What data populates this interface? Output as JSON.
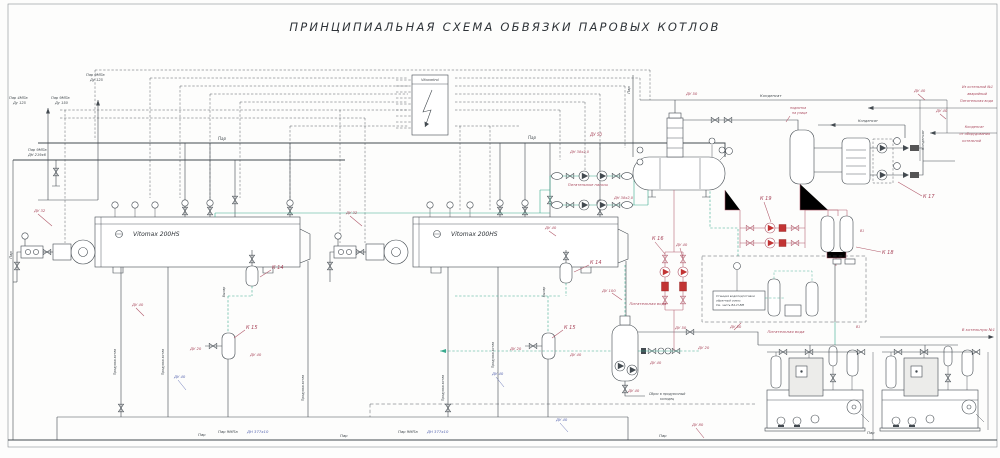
{
  "title": "ПРИНЦИПИАЛЬНАЯ СХЕМА ОБВЯЗКИ ПАРОВЫХ КОТЛОВ",
  "colors": {
    "ink": "#3f464b",
    "red": "#a8455a",
    "teal": "#3aaa8e",
    "blue": "#5463ae",
    "dark": "#2e3338"
  },
  "equipment": {
    "boiler1": "Vitomax 200HS",
    "boiler2": "Vitomax 200HS",
    "panel": "Vitocontrol"
  },
  "labels": [
    {
      "t": "Пар 9МПа",
      "x": 86,
      "y": 76,
      "s": 3.6
    },
    {
      "t": "Ду 125",
      "x": 90,
      "y": 81,
      "s": 3.6
    },
    {
      "t": "Пар 4МПа",
      "x": 9,
      "y": 99,
      "s": 3.6
    },
    {
      "t": "Ду 125",
      "x": 13,
      "y": 104,
      "s": 3.6
    },
    {
      "t": "Пар 9МПа",
      "x": 51,
      "y": 99,
      "s": 3.6
    },
    {
      "t": "Ду 150",
      "x": 55,
      "y": 104,
      "s": 3.6
    },
    {
      "t": "Пар 9МПа",
      "x": 28,
      "y": 151,
      "s": 3.6
    },
    {
      "t": "ДН 219х6",
      "x": 28,
      "y": 156,
      "s": 3.6
    },
    {
      "t": "Пар",
      "x": 218,
      "y": 140,
      "s": 4
    },
    {
      "t": "Пар",
      "x": 528,
      "y": 139,
      "s": 4
    },
    {
      "t": "ДУ 50",
      "x": 590,
      "y": 136,
      "c": "red",
      "s": 4
    },
    {
      "t": "ДН 38х2,0",
      "x": 570,
      "y": 153,
      "c": "red",
      "s": 3.6
    },
    {
      "t": "ДН 38х2,0",
      "x": 614,
      "y": 199,
      "c": "red",
      "s": 3.6
    },
    {
      "t": "Питательные насосы",
      "x": 588,
      "y": 186,
      "c": "red",
      "s": 3.6,
      "a": "middle"
    },
    {
      "t": "К 14",
      "x": 272,
      "y": 269,
      "c": "red",
      "s": 5
    },
    {
      "t": "К 14",
      "x": 590,
      "y": 264,
      "c": "red",
      "s": 5
    },
    {
      "t": "К 15",
      "x": 246,
      "y": 329,
      "c": "red",
      "s": 5
    },
    {
      "t": "К 15",
      "x": 564,
      "y": 329,
      "c": "red",
      "s": 5
    },
    {
      "t": "К 16",
      "x": 652,
      "y": 240,
      "c": "red",
      "s": 5
    },
    {
      "t": "ДУ 40",
      "x": 676,
      "y": 246,
      "c": "red",
      "s": 3.8
    },
    {
      "t": "К 19",
      "x": 760,
      "y": 200,
      "c": "red",
      "s": 5
    },
    {
      "t": "К 17",
      "x": 923,
      "y": 198,
      "c": "red",
      "s": 5
    },
    {
      "t": "К 18",
      "x": 882,
      "y": 254,
      "c": "red",
      "s": 5
    },
    {
      "t": "В1",
      "x": 860,
      "y": 232,
      "c": "red",
      "s": 3.2
    },
    {
      "t": "В1",
      "x": 856,
      "y": 328,
      "c": "red",
      "s": 3.2
    },
    {
      "t": "ДУ 50",
      "x": 686,
      "y": 95,
      "c": "red",
      "s": 3.8
    },
    {
      "t": "Конденсат",
      "x": 760,
      "y": 97,
      "s": 3.8
    },
    {
      "t": "Конденсат",
      "x": 858,
      "y": 122,
      "s": 3.5
    },
    {
      "t": "Конденсат",
      "x": 924,
      "y": 140,
      "s": 3.5,
      "r": -90,
      "a": "middle"
    },
    {
      "t": "подпитка",
      "x": 790,
      "y": 109,
      "c": "red",
      "s": 3.2
    },
    {
      "t": "на улице",
      "x": 792,
      "y": 114,
      "c": "red",
      "s": 3.2
    },
    {
      "t": "ДУ 40",
      "x": 914,
      "y": 92,
      "c": "red",
      "s": 3.8
    },
    {
      "t": "Из котельной №1",
      "x": 993,
      "y": 88,
      "c": "red",
      "s": 3.4,
      "a": "end"
    },
    {
      "t": "аварийный",
      "x": 987,
      "y": 95,
      "c": "red",
      "s": 3.4,
      "a": "end"
    },
    {
      "t": "Питательная вода",
      "x": 993,
      "y": 102,
      "c": "red",
      "s": 3.4,
      "a": "end"
    },
    {
      "t": "ДУ 40",
      "x": 936,
      "y": 112,
      "c": "red",
      "s": 3.8
    },
    {
      "t": "Конденсат",
      "x": 984,
      "y": 128,
      "c": "red",
      "s": 3.4,
      "a": "end"
    },
    {
      "t": "от оборудования",
      "x": 990,
      "y": 135,
      "c": "red",
      "s": 3.4,
      "a": "end"
    },
    {
      "t": "котельной",
      "x": 981,
      "y": 142,
      "c": "red",
      "s": 3.4,
      "a": "end"
    },
    {
      "t": "Станция водоподготовки",
      "x": 716,
      "y": 297,
      "s": 2.9
    },
    {
      "t": "обратный осмос",
      "x": 716,
      "y": 301.5,
      "s": 2.9
    },
    {
      "t": "См. часть ВА-П-ВМ",
      "x": 716,
      "y": 306,
      "s": 2.9
    },
    {
      "t": "ДУ 50",
      "x": 730,
      "y": 328,
      "c": "red",
      "s": 3.8
    },
    {
      "t": "Питательная вода",
      "x": 786,
      "y": 333,
      "c": "red",
      "s": 3.8,
      "a": "middle"
    },
    {
      "t": "ДУ 100",
      "x": 602,
      "y": 292,
      "c": "red",
      "s": 3.8
    },
    {
      "t": "Питательная вода",
      "x": 648,
      "y": 305,
      "c": "red",
      "s": 3.8,
      "a": "middle"
    },
    {
      "t": "ДУ 50",
      "x": 675,
      "y": 329,
      "c": "red",
      "s": 3.8
    },
    {
      "t": "ДУ 20",
      "x": 698,
      "y": 349,
      "c": "red",
      "s": 3.8
    },
    {
      "t": "ДУ 40",
      "x": 650,
      "y": 364,
      "c": "red",
      "s": 3.8
    },
    {
      "t": "ДУ 40",
      "x": 628,
      "y": 392,
      "c": "red",
      "s": 3.8
    },
    {
      "t": "Сброс в продувочный",
      "x": 649,
      "y": 395,
      "s": 3.2
    },
    {
      "t": "колодец",
      "x": 660,
      "y": 400,
      "s": 3.2
    },
    {
      "t": "В котельную №1",
      "x": 995,
      "y": 331,
      "c": "red",
      "s": 3.8,
      "a": "end"
    },
    {
      "t": "Пар",
      "x": 198,
      "y": 436,
      "s": 3.8
    },
    {
      "t": "Пар 9МПа",
      "x": 218,
      "y": 433,
      "s": 3.8
    },
    {
      "t": "ДН 377х10",
      "x": 247,
      "y": 433,
      "c": "blue",
      "s": 3.8
    },
    {
      "t": "Пар",
      "x": 340,
      "y": 437,
      "s": 3.8
    },
    {
      "t": "Пар 9МПа",
      "x": 398,
      "y": 433,
      "s": 3.8
    },
    {
      "t": "ДН 377х10",
      "x": 427,
      "y": 433,
      "c": "blue",
      "s": 3.8
    },
    {
      "t": "Пар",
      "x": 659,
      "y": 437,
      "s": 3.8
    },
    {
      "t": "ДУ 80",
      "x": 692,
      "y": 426,
      "c": "red",
      "s": 3.8
    },
    {
      "t": "Пар",
      "x": 867,
      "y": 434,
      "s": 3.8
    },
    {
      "t": "Продувка котла",
      "x": 116,
      "y": 362,
      "s": 3.1,
      "r": -90,
      "a": "middle"
    },
    {
      "t": "Продувка котла",
      "x": 164,
      "y": 362,
      "s": 3.1,
      "r": -90,
      "a": "middle"
    },
    {
      "t": "Продувка котла",
      "x": 304,
      "y": 388,
      "s": 3.1,
      "r": -90,
      "a": "middle"
    },
    {
      "t": "Продувка котла",
      "x": 444,
      "y": 388,
      "s": 3.1,
      "r": -90,
      "a": "middle"
    },
    {
      "t": "Продувка котла",
      "x": 494,
      "y": 355,
      "s": 3.1,
      "r": -90,
      "a": "middle"
    },
    {
      "t": "Выпар",
      "x": 225,
      "y": 292,
      "s": 3.1,
      "r": -90,
      "a": "middle"
    },
    {
      "t": "Выпар",
      "x": 545,
      "y": 292,
      "s": 3.1,
      "r": -90,
      "a": "middle"
    },
    {
      "t": "ДУ 40",
      "x": 132,
      "y": 306,
      "c": "red",
      "s": 3.8
    },
    {
      "t": "ДУ 40",
      "x": 174,
      "y": 378,
      "c": "blue",
      "s": 3.8
    },
    {
      "t": "ДУ 40",
      "x": 492,
      "y": 375,
      "c": "blue",
      "s": 3.8
    },
    {
      "t": "ДУ 40",
      "x": 556,
      "y": 421,
      "c": "blue",
      "s": 3.8
    },
    {
      "t": "ДУ 32",
      "x": 34,
      "y": 212,
      "c": "red",
      "s": 3.8
    },
    {
      "t": "ДУ 32",
      "x": 346,
      "y": 214,
      "c": "red",
      "s": 3.8
    },
    {
      "t": "ДУ 20",
      "x": 190,
      "y": 350,
      "c": "red",
      "s": 3.8
    },
    {
      "t": "ДУ 40",
      "x": 250,
      "y": 356,
      "c": "red",
      "s": 3.8
    },
    {
      "t": "ДУ 20",
      "x": 510,
      "y": 350,
      "c": "red",
      "s": 3.8
    },
    {
      "t": "ДУ 40",
      "x": 570,
      "y": 356,
      "c": "red",
      "s": 3.8
    },
    {
      "t": "ДУ 40",
      "x": 545,
      "y": 229,
      "c": "red",
      "s": 3.8
    },
    {
      "t": "Пар",
      "x": 12,
      "y": 255,
      "s": 3.8,
      "r": -90,
      "a": "middle"
    },
    {
      "t": "Пар",
      "x": 630,
      "y": 90,
      "s": 3.8,
      "r": -90,
      "a": "middle"
    }
  ]
}
